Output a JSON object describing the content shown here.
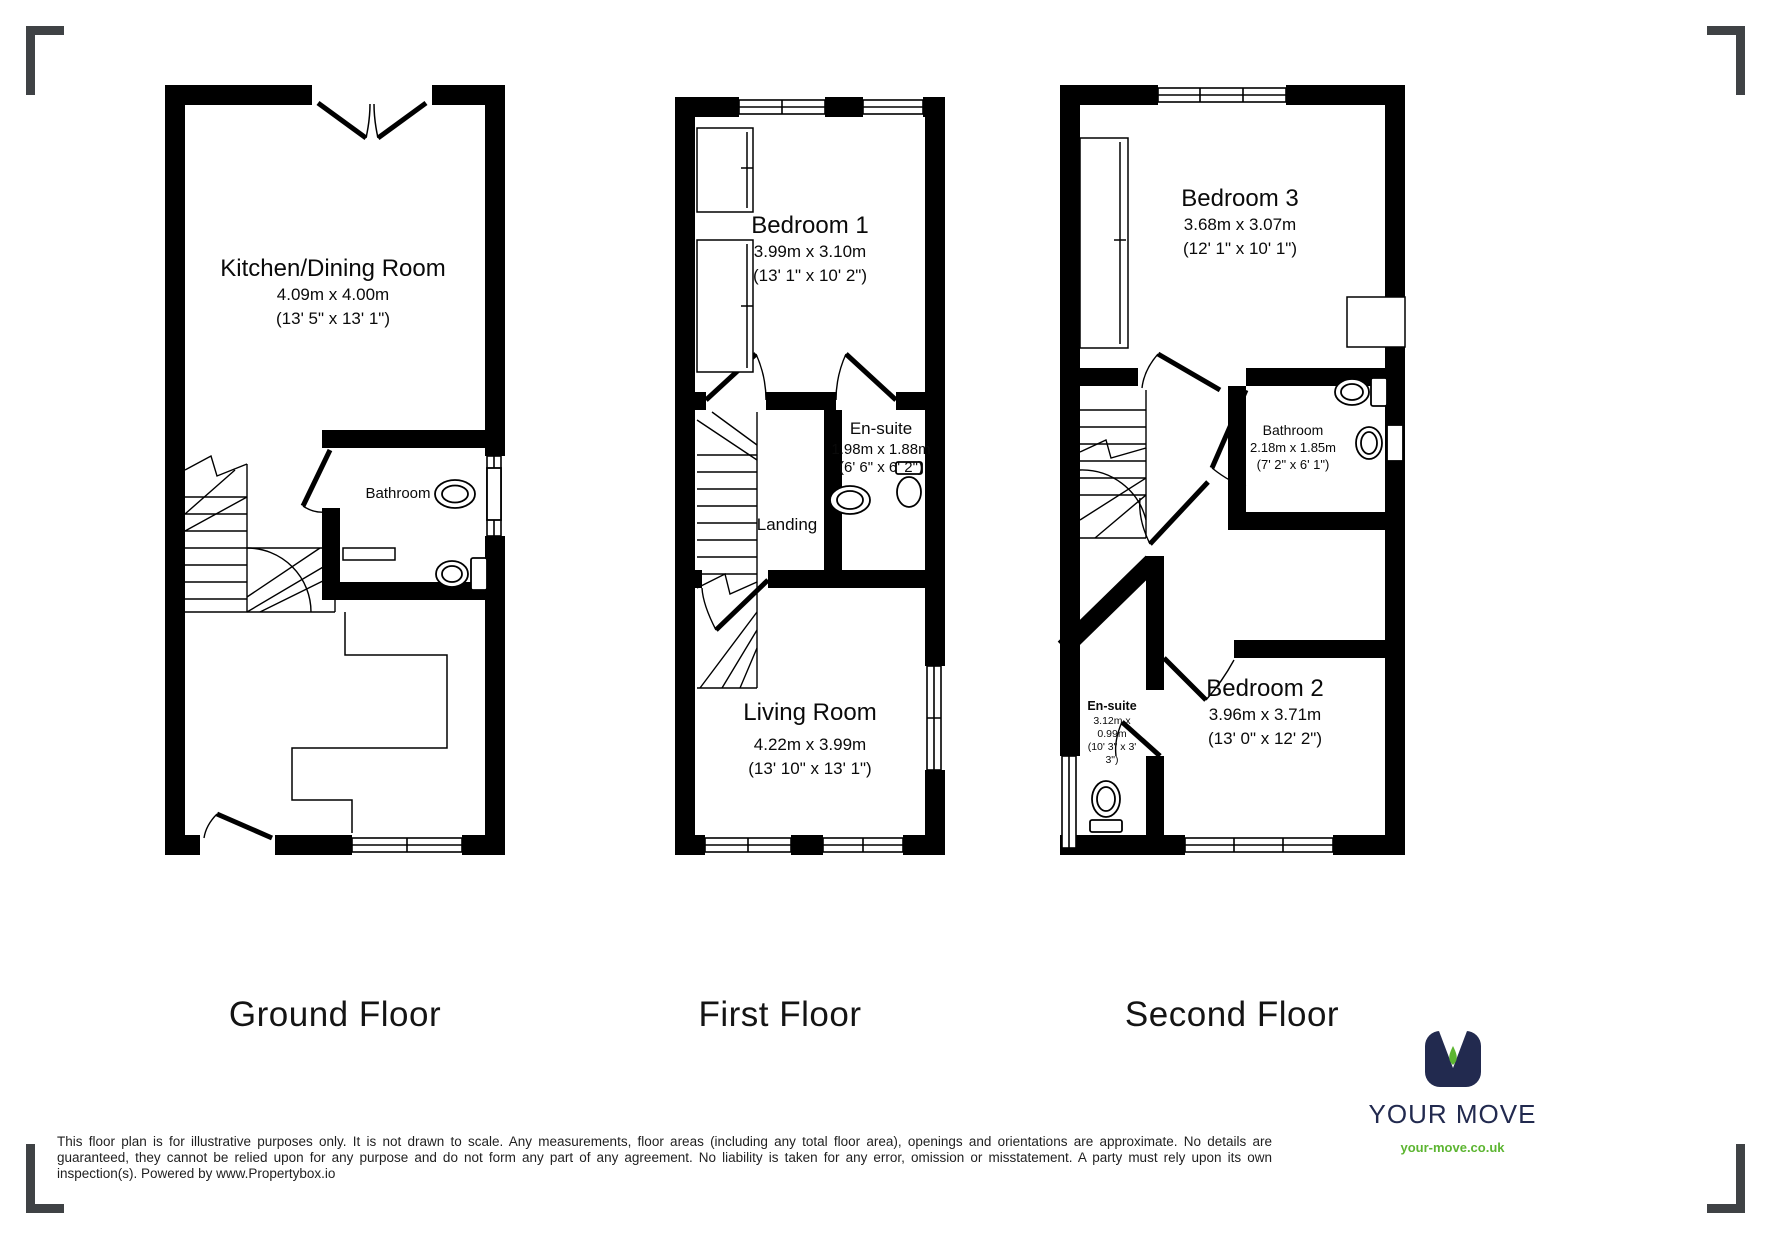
{
  "floors": [
    {
      "title": "Ground Floor",
      "rooms": {
        "kitchen": {
          "name": "Kitchen/Dining Room",
          "metric": "4.09m x 4.00m",
          "imperial": "(13' 5\" x 13' 1\")"
        },
        "bathroom": {
          "name": "Bathroom"
        }
      }
    },
    {
      "title": "First Floor",
      "rooms": {
        "bedroom1": {
          "name": "Bedroom 1",
          "metric": "3.99m x 3.10m",
          "imperial": "(13' 1\" x 10' 2\")"
        },
        "ensuite": {
          "name": "En-suite",
          "metric": "1.98m x 1.88m",
          "imperial": "(6' 6\" x 6' 2\")"
        },
        "landing": {
          "name": "Landing"
        },
        "living": {
          "name": "Living Room",
          "metric": "4.22m x 3.99m",
          "imperial": "(13' 10\" x 13' 1\")"
        }
      }
    },
    {
      "title": "Second Floor",
      "rooms": {
        "bedroom3": {
          "name": "Bedroom 3",
          "metric": "3.68m x 3.07m",
          "imperial": "(12' 1\" x 10' 1\")"
        },
        "bathroom": {
          "name": "Bathroom",
          "metric": "2.18m x 1.85m",
          "imperial": "(7' 2\" x 6' 1\")"
        },
        "ensuite": {
          "name": "En-suite",
          "metric_line1": "3.12m x",
          "metric_line2": "0.99m",
          "imperial_line1": "(10' 3\" x 3'",
          "imperial_line2": "3\")"
        },
        "bedroom2": {
          "name": "Bedroom 2",
          "metric": "3.96m x 3.71m",
          "imperial": "(13' 0\" x 12' 2\")"
        }
      }
    }
  ],
  "disclaimer": "This floor plan is for illustrative purposes only. It is not drawn to scale. Any measurements, floor areas (including any total floor area), openings and orientations are approximate. No details are guaranteed, they cannot be relied upon for any purpose and do not form any part of any agreement. No liability is taken for any error, omission or misstatement. A party must rely upon its own inspection(s). Powered by www.Propertybox.io",
  "branding": {
    "logo_text": "YOUR MOVE",
    "website": "your-move.co.uk",
    "navy": "#222a4f",
    "green": "#5cb531"
  }
}
